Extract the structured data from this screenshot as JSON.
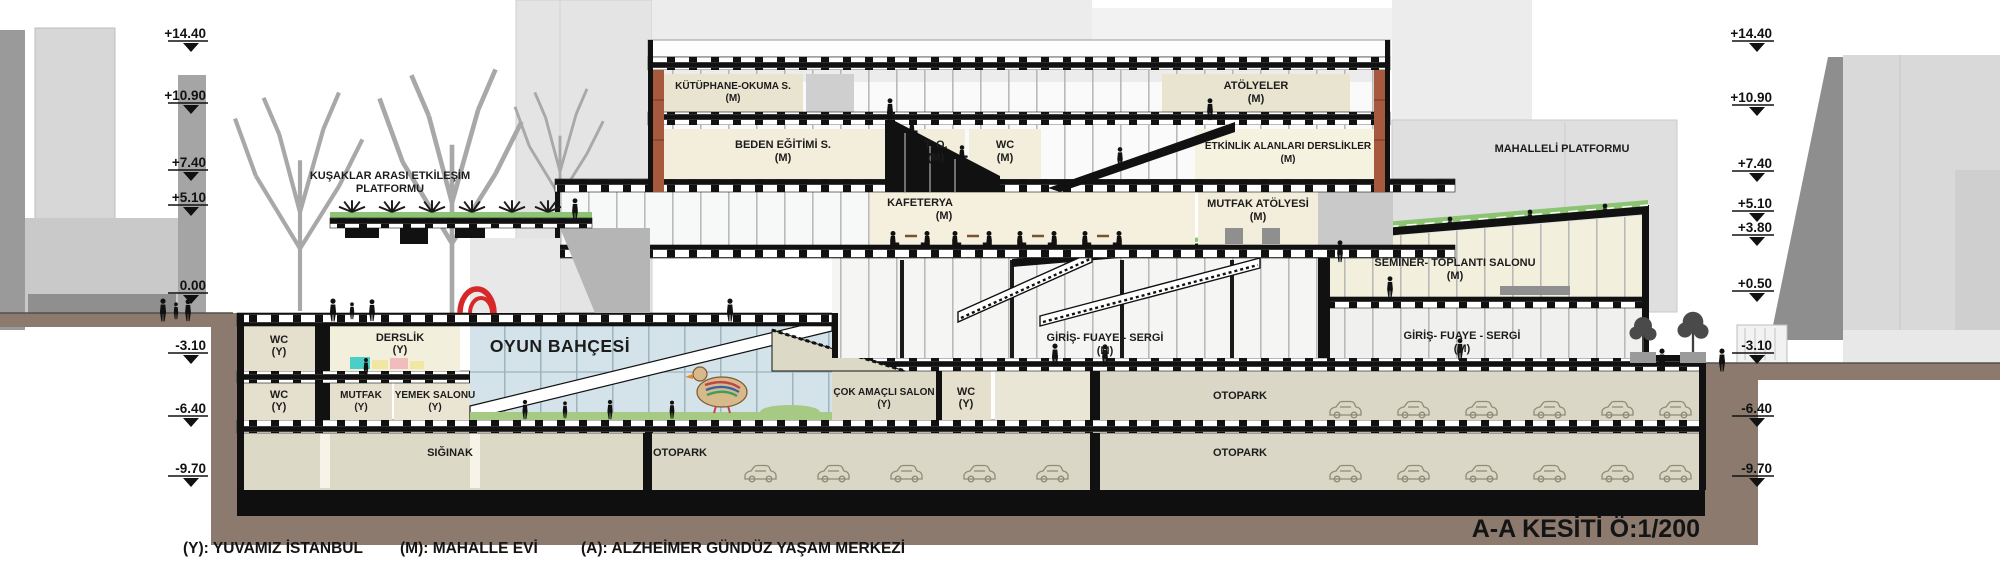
{
  "meta": {
    "title": "A-A KESİTİ Ö:1/200",
    "legend_y": "(Y): YUVAMIZ İSTANBUL",
    "legend_m": "(M): MAHALLE EVİ",
    "legend_a": "(A): ALZHEİMER GÜNDÜZ YAŞAM MERKEZİ"
  },
  "elevations": {
    "left": [
      "+14.40",
      "+10.90",
      "+7.40",
      "+5.10",
      "0.00",
      "-3.10",
      "-6.40",
      "-9.70"
    ],
    "right": [
      "+14.40",
      "+10.90",
      "+7.40",
      "+5.10",
      "+3.80",
      "+0.50",
      "-3.10",
      "-6.40",
      "-9.70"
    ]
  },
  "rooms": {
    "kutuphane": {
      "name": "KÜTÜPHANE-OKUMA S.",
      "tag": "(M)"
    },
    "atolyeler": {
      "name": "ATÖLYELER",
      "tag": "(M)"
    },
    "beden": {
      "name": "BEDEN EĞİTİMİ S.",
      "tag": "(M)"
    },
    "to": {
      "name": "T. O.",
      "tag": "(M)"
    },
    "wc_m": {
      "name": "WC",
      "tag": "(M)"
    },
    "etkinlik": {
      "name": "ETKİNLİK ALANLARI DERSLİKLER",
      "tag": "(M)"
    },
    "kafeterya": {
      "name": "KAFETERYA",
      "tag": "(M)"
    },
    "mutfak_atolyesi": {
      "name": "MUTFAK ATÖLYESİ",
      "tag": "(M)"
    },
    "seminer": {
      "name": "SEMİNER- TOPLANTI SALONU",
      "tag": "(M)"
    },
    "giris_merkez": {
      "name": "GİRİŞ- FUAYE - SERGİ",
      "tag": "(M)"
    },
    "giris_sag": {
      "name": "GİRİŞ- FUAYE - SERGİ",
      "tag": "(M)"
    },
    "oyun": {
      "name": "OYUN BAHÇESİ"
    },
    "derslik": {
      "name": "DERSLİK",
      "tag": "(Y)"
    },
    "wc_y_ust": {
      "name": "WC",
      "tag": "(Y)"
    },
    "wc_y_orta": {
      "name": "WC",
      "tag": "(Y)"
    },
    "mutfak_y": {
      "name": "MUTFAK",
      "tag": "(Y)"
    },
    "yemek": {
      "name": "YEMEK SALONU",
      "tag": "(Y)"
    },
    "cok_amacli": {
      "name": "ÇOK AMAÇLI SALON",
      "tag": "(Y)"
    },
    "wc_y_salon": {
      "name": "WC",
      "tag": "(Y)"
    },
    "otopark_ust": {
      "name": "OTOPARK"
    },
    "otopark_orta": {
      "name": "OTOPARK"
    },
    "otopark_alt": {
      "name": "OTOPARK"
    },
    "siginak": {
      "name": "SIĞINAK"
    },
    "kusaklar": {
      "line1": "KUŞAKLAR ARASI ETKİLEŞİM",
      "line2": "PLATFORMU"
    },
    "mahalleli": {
      "name": "MAHALLELİ PLATFORMU"
    }
  },
  "colors": {
    "ground_brown": "#8b7a6d",
    "structure_black": "#111111",
    "room_beige": "#e9e5d2",
    "room_cream": "#f3efdd",
    "parking_floor": "#dad7c6",
    "glass_blue": "#d4e2ea",
    "platform_green": "#8cc474",
    "brick_orange": "#a7593e",
    "sculpture_red": "#d62828",
    "city_gray": "#d9d9d9"
  }
}
